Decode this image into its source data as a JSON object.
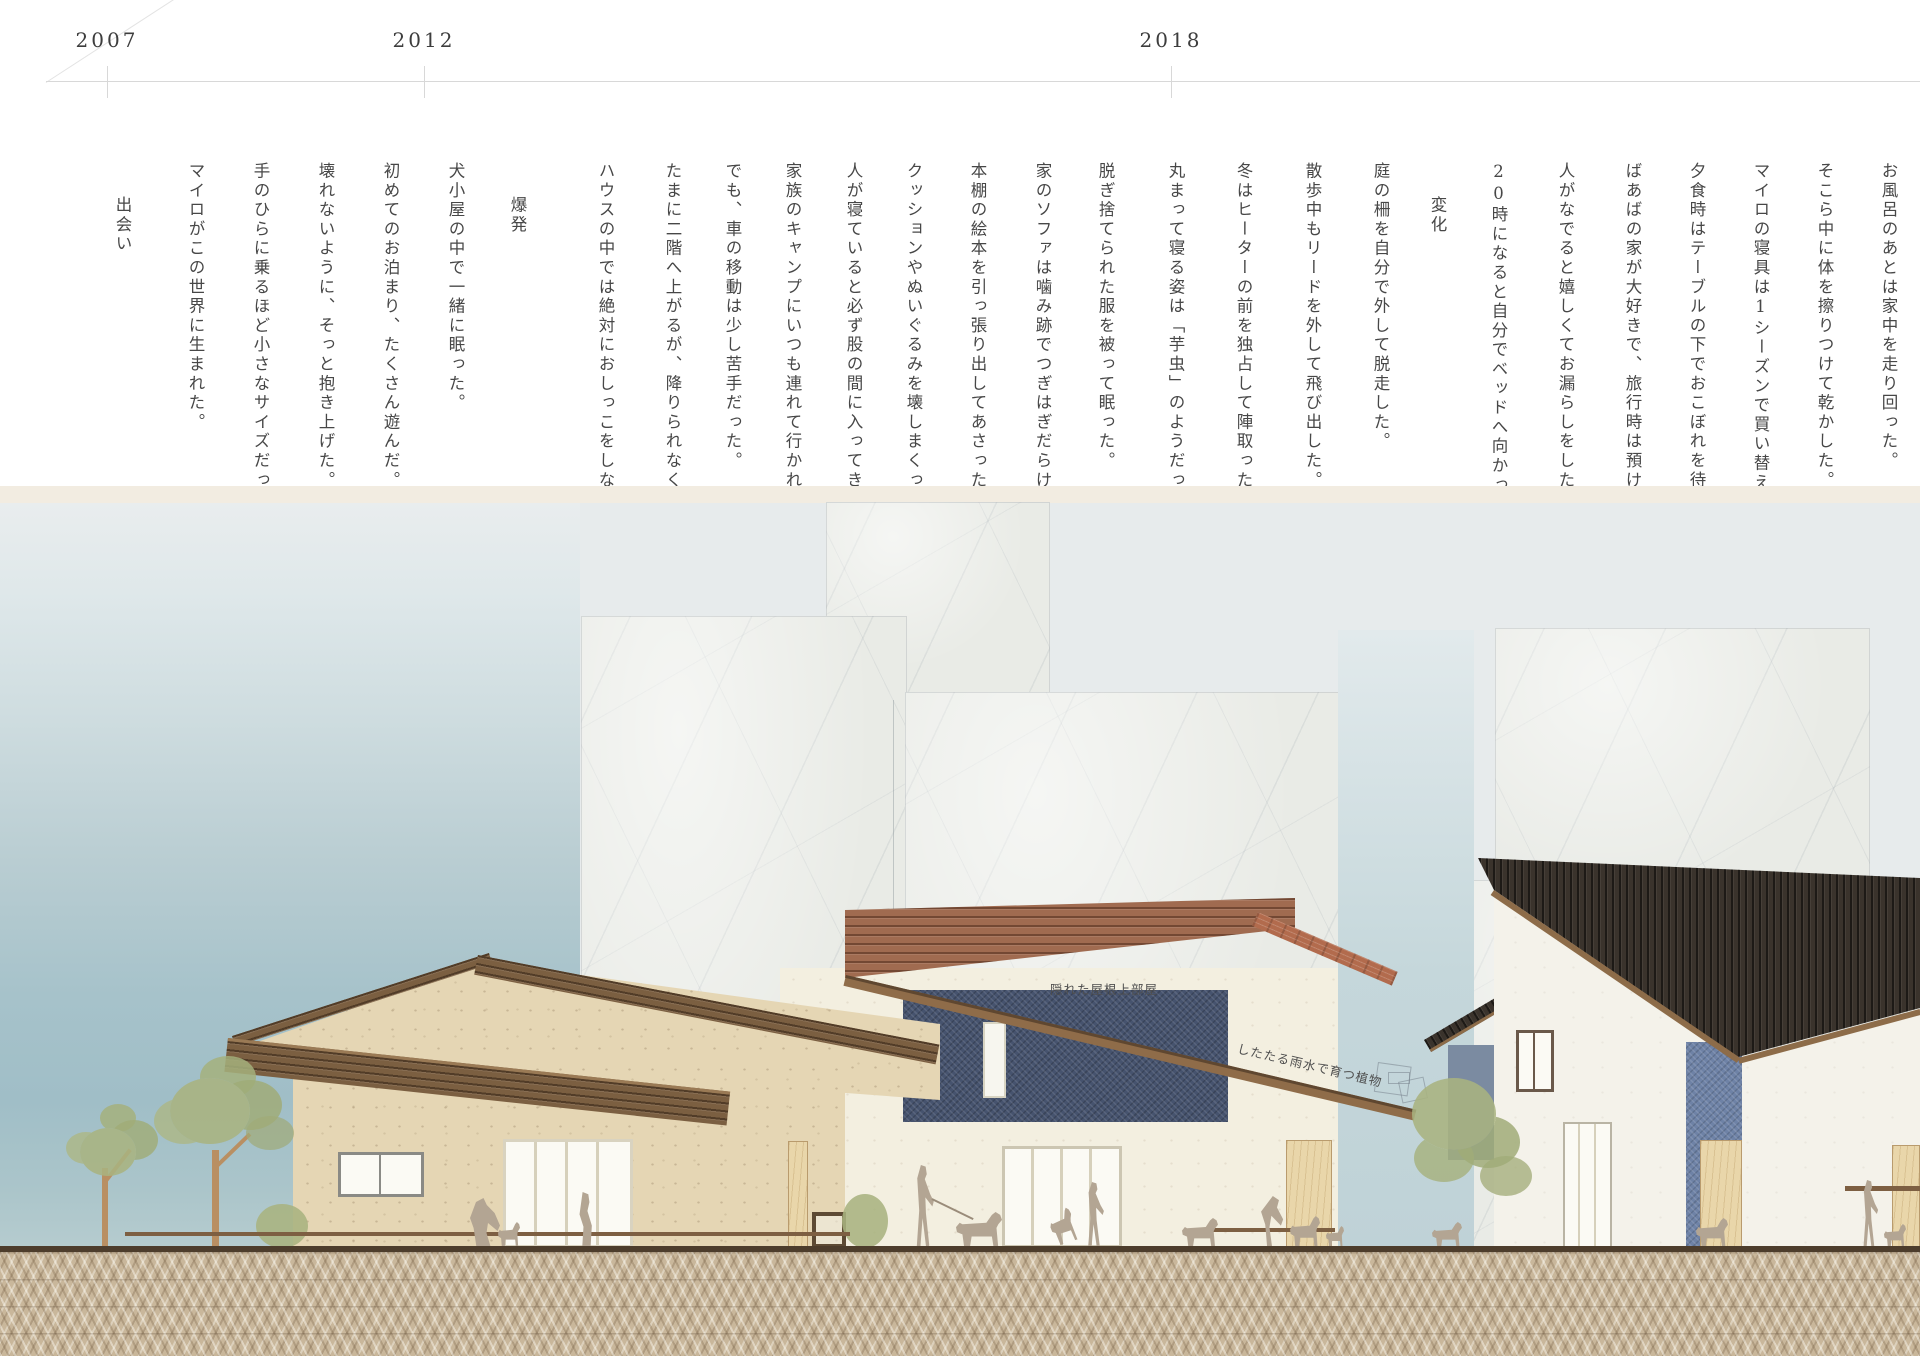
{
  "title": "マイロの成長タイムラインと住まいの立面図",
  "timeline": {
    "years": [
      {
        "label": "2007",
        "x": 107
      },
      {
        "label": "2012",
        "x": 424
      },
      {
        "label": "2018",
        "x": 1171
      }
    ]
  },
  "sections": [
    {
      "heading": "出会い",
      "heading_x": 122,
      "columns": [
        {
          "x": 195,
          "text": "マイロがこの世界に生まれた。"
        },
        {
          "x": 260,
          "text": "手のひらに乗るほど小さなサイズだった"
        },
        {
          "x": 325,
          "text": "壊れないように、そっと抱き上げた。"
        },
        {
          "x": 390,
          "text": "初めてのお泊まり、たくさん遊んだ。"
        },
        {
          "x": 455,
          "text": "犬小屋の中で一緒に眠った。"
        }
      ]
    },
    {
      "heading": "爆発",
      "heading_x": 517,
      "columns": [
        {
          "x": 605,
          "text": "ハウスの中では絶対におしっこをしなか"
        },
        {
          "x": 672,
          "text": "たまに二階へ上がるが、降りられなくな"
        },
        {
          "x": 732,
          "text": "でも、車の移動は少し苦手だった。"
        },
        {
          "x": 792,
          "text": "家族のキャンプにいつも連れて行かれた"
        },
        {
          "x": 853,
          "text": "人が寝ていると必ず股の間に入ってきた"
        },
        {
          "x": 913,
          "text": "クッションやぬいぐるみを壊しまくった"
        },
        {
          "x": 977,
          "text": "本棚の絵本を引っ張り出してあさった。"
        },
        {
          "x": 1042,
          "text": "家のソファは噛み跡でつぎはぎだらけだ"
        },
        {
          "x": 1105,
          "text": "脱ぎ捨てられた服を被って眠った。"
        },
        {
          "x": 1175,
          "text": "丸まって寝る姿は「芋虫」のようだった"
        },
        {
          "x": 1243,
          "text": "冬はヒーターの前を独占して陣取った。"
        },
        {
          "x": 1312,
          "text": "散歩中もリードを外して飛び出した。"
        },
        {
          "x": 1380,
          "text": "庭の柵を自分で外して脱走した。"
        }
      ]
    },
    {
      "heading": "変化",
      "heading_x": 1437,
      "columns": [
        {
          "x": 1498,
          "text": "20時になると自分でベッドへ向かった。"
        },
        {
          "x": 1565,
          "text": "人がなでると嬉しくてお漏らしをした。"
        },
        {
          "x": 1632,
          "text": "ばあばの家が大好きで、旅行時は預けた"
        },
        {
          "x": 1696,
          "text": "夕食時はテーブルの下でおこぼれを待っ"
        },
        {
          "x": 1760,
          "text": "マイロの寝具は1シーズンで買い替えた"
        },
        {
          "x": 1824,
          "text": "そこら中に体を擦りつけて乾かした。"
        },
        {
          "x": 1888,
          "text": "お風呂のあとは家中を走り回った。"
        }
      ]
    }
  ],
  "architecture": {
    "labels": {
      "hidden_roof_room": "隠れた屋根上部屋",
      "rain_plants": "したたる雨水で育つ植物"
    }
  },
  "colors": {
    "page_bg": "#ffffff",
    "text": "#474747",
    "timeline": "#d8d8d8",
    "band": "#f2ece1",
    "washi": "#e9ebe6",
    "wood": "#7b5f41",
    "wood_red": "#a06b50",
    "terracotta": "#b26b4d",
    "roof_black": "#3a332c",
    "denim_dark": "#46536e",
    "denim_light": "#6e82a6",
    "stucco_tan": "#e5d6b4",
    "wall_cream": "#f3efe0",
    "wall_white": "#f4f2ea",
    "pine": "#e9d6aa",
    "foliage": "#a9b382",
    "trunk": "#b98f62",
    "figure": "#b3a593",
    "pavement": "#c9b79b",
    "ground": "#4d3d2c",
    "sky_teal": "#a0bec7"
  }
}
